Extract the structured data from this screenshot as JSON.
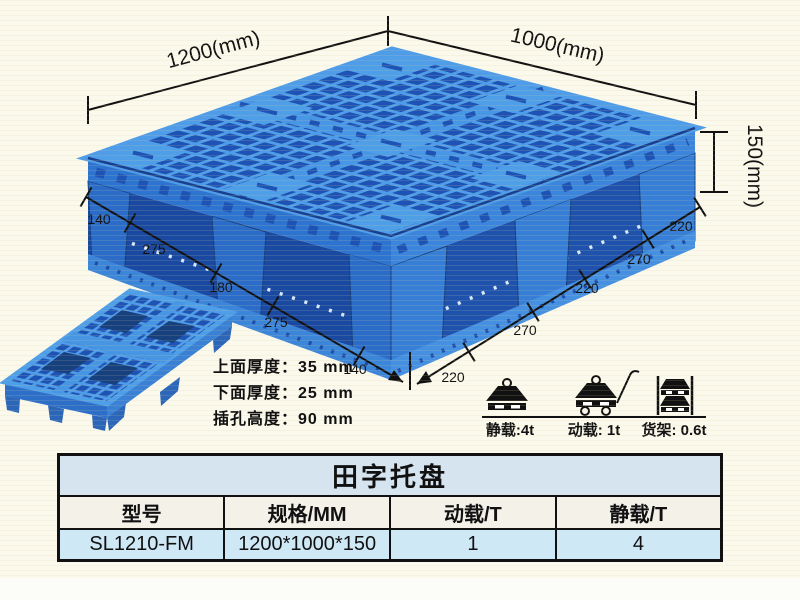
{
  "illustration": {
    "dimensions": {
      "length_label": "1200(mm)",
      "width_label": "1000(mm)",
      "height_label": "150(mm)",
      "left_edge_segments": [
        "140",
        "275",
        "180",
        "275",
        "140"
      ],
      "right_edge_segments": [
        "220",
        "270",
        "220",
        "270",
        "220"
      ]
    },
    "thickness_notes": [
      "上面厚度：35 mm",
      "下面厚度：25 mm",
      "插孔高度：90 mm"
    ],
    "load_ratings": [
      {
        "icon": "static-load-icon",
        "label": "静载:4t"
      },
      {
        "icon": "dynamic-load-icon",
        "label": "动载: 1t"
      },
      {
        "icon": "rack-load-icon",
        "label": "货架: 0.6t"
      }
    ]
  },
  "table": {
    "title": "田字托盘",
    "headers": [
      "型号",
      "规格/MM",
      "动载/T",
      "静载/T"
    ],
    "rows": [
      [
        "SL1210-FM",
        "1200*1000*150",
        "1",
        "4"
      ]
    ]
  },
  "colors": {
    "pallet_blue": "#3E8FE0",
    "pallet_rib_highlight": "#4F9CE8",
    "pallet_hole_dark": "#1D53B4",
    "table_title_bg": "#D6E4EF",
    "table_header_bg": "#F4F1E9",
    "table_row_bg": "#CFE8F6",
    "page_bg": "#FBF9EC",
    "line_color": "#111111"
  }
}
